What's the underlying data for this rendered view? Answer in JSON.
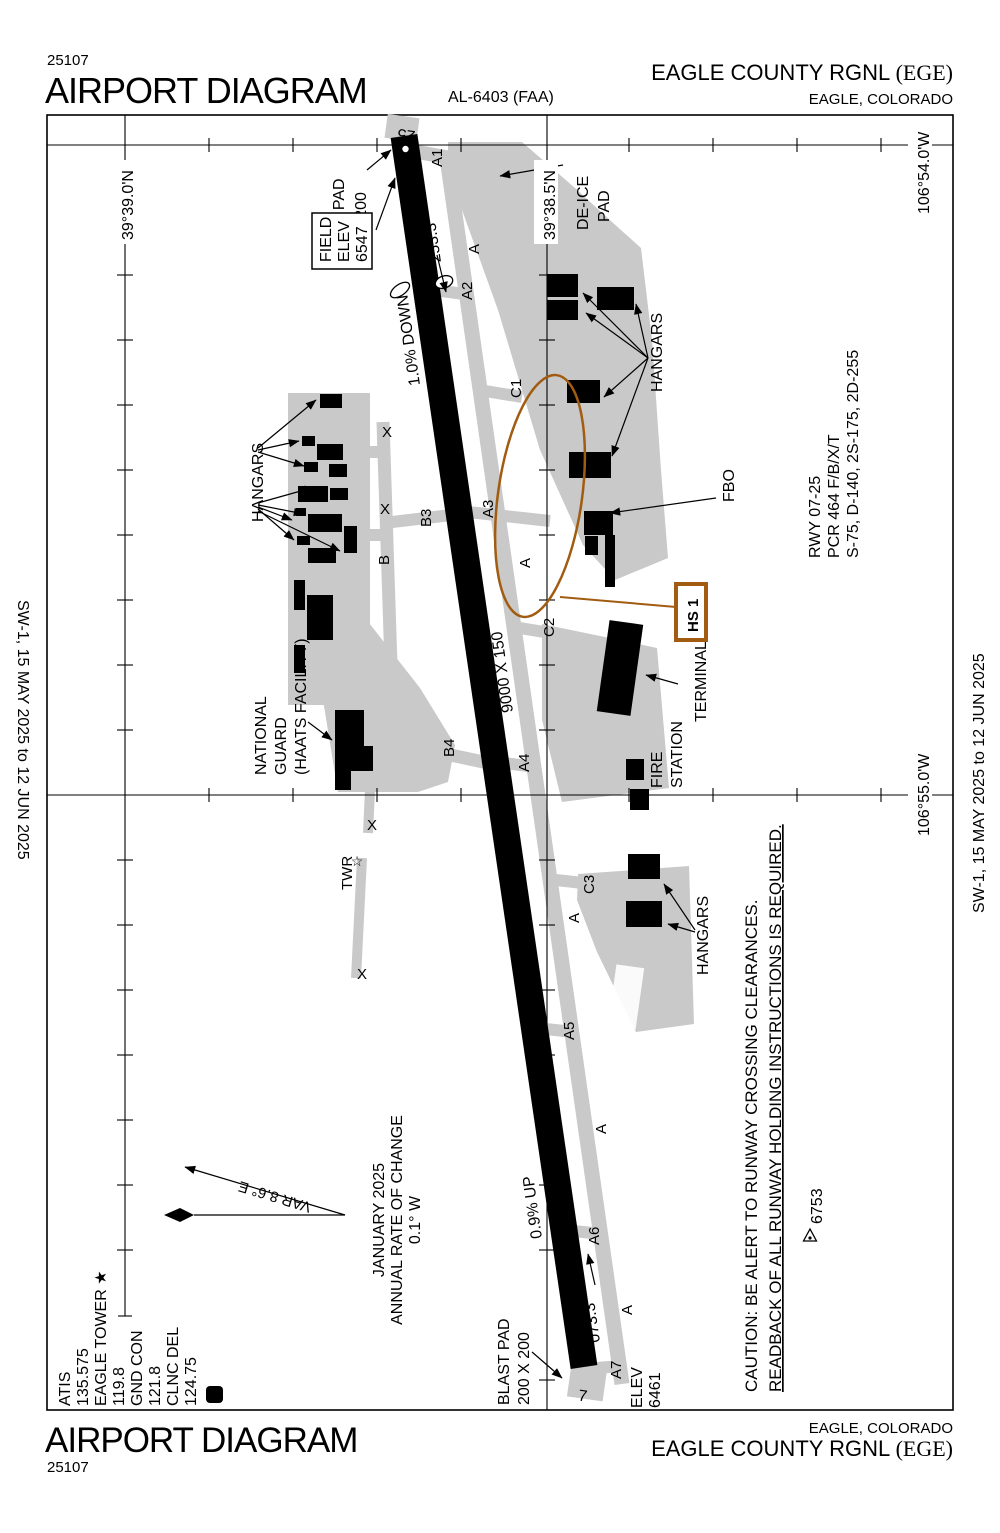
{
  "doc": {
    "chart_number": "25107",
    "title": "AIRPORT DIAGRAM",
    "al_number": "AL-6403 (FAA)",
    "airport_name": "EAGLE COUNTY RGNL",
    "airport_icao": "(EGE)",
    "city_state": "EAGLE, COLORADO",
    "edge_note": "SW-1,  15 MAY 2025 to 12 JUN 2025"
  },
  "comm": {
    "atis_label": "ATIS",
    "atis_freq": "135.575",
    "tower_label": "EAGLE TOWER ★",
    "tower_freq": "119.8",
    "gnd_label": "GND CON",
    "gnd_freq": "121.8",
    "clnc_label": "CLNC DEL",
    "clnc_freq": "124.75",
    "datis_symbol": "D"
  },
  "grid": {
    "lat_top": "39°39.0'N",
    "lat_mid": "39°38.5'N",
    "lon_top": "106°54.0'W",
    "lon_bottom": "106°55.0'W"
  },
  "runway": {
    "end_25": "25",
    "end_7": "7",
    "heading_25": "253.3°",
    "heading_7": "073.3°",
    "dimensions": "9000 X 150",
    "slope_north": "1.0% DOWN",
    "slope_south": "0.9% UP",
    "elev_label": "ELEV",
    "elev_value": "6461",
    "info_line1": "RWY 07-25",
    "info_line2": "PCR 464 F/B/X/T",
    "info_line3": "S-75, D-140, 2S-175, 2D-255"
  },
  "field_elev": {
    "l1": "FIELD",
    "l2": "ELEV",
    "l3": "6547"
  },
  "blast_pad": {
    "l1": "BLAST PAD",
    "l2": "200 X 200"
  },
  "taxiways": {
    "a": "A",
    "a1": "A1",
    "a2": "A2",
    "a3": "A3",
    "a4": "A4",
    "a5": "A5",
    "a6": "A6",
    "a7": "A7",
    "b": "B",
    "b3": "B3",
    "b4": "B4",
    "c1": "C1",
    "c2": "C2",
    "c3": "C3",
    "closed": "X"
  },
  "facilities": {
    "deice_l1": "DE-ICE",
    "deice_l2": "PAD",
    "hangars": "HANGARS",
    "fbo": "FBO",
    "terminal": "TERMINAL",
    "fire_l1": "FIRE",
    "fire_l2": "STATION",
    "ng_l1": "NATIONAL",
    "ng_l2": "GUARD",
    "ng_l3": "(HAATS FACILITY)",
    "twr": "TWR",
    "twr_star": "☆",
    "hotspot": "HS 1",
    "obstruction_elev": "6753"
  },
  "variation": {
    "var_text": "VAR 8.6° E",
    "date": "JANUARY 2025",
    "rate_label": "ANNUAL RATE OF CHANGE",
    "rate_value": "0.1° W"
  },
  "caution": {
    "line1": "CAUTION: BE ALERT TO RUNWAY CROSSING CLEARANCES.",
    "line2": "READBACK OF ALL RUNWAY HOLDING INSTRUCTIONS IS REQUIRED."
  },
  "colors": {
    "hotspot_brown": "#A15C11",
    "apron_gray": "#C9C9C9"
  }
}
